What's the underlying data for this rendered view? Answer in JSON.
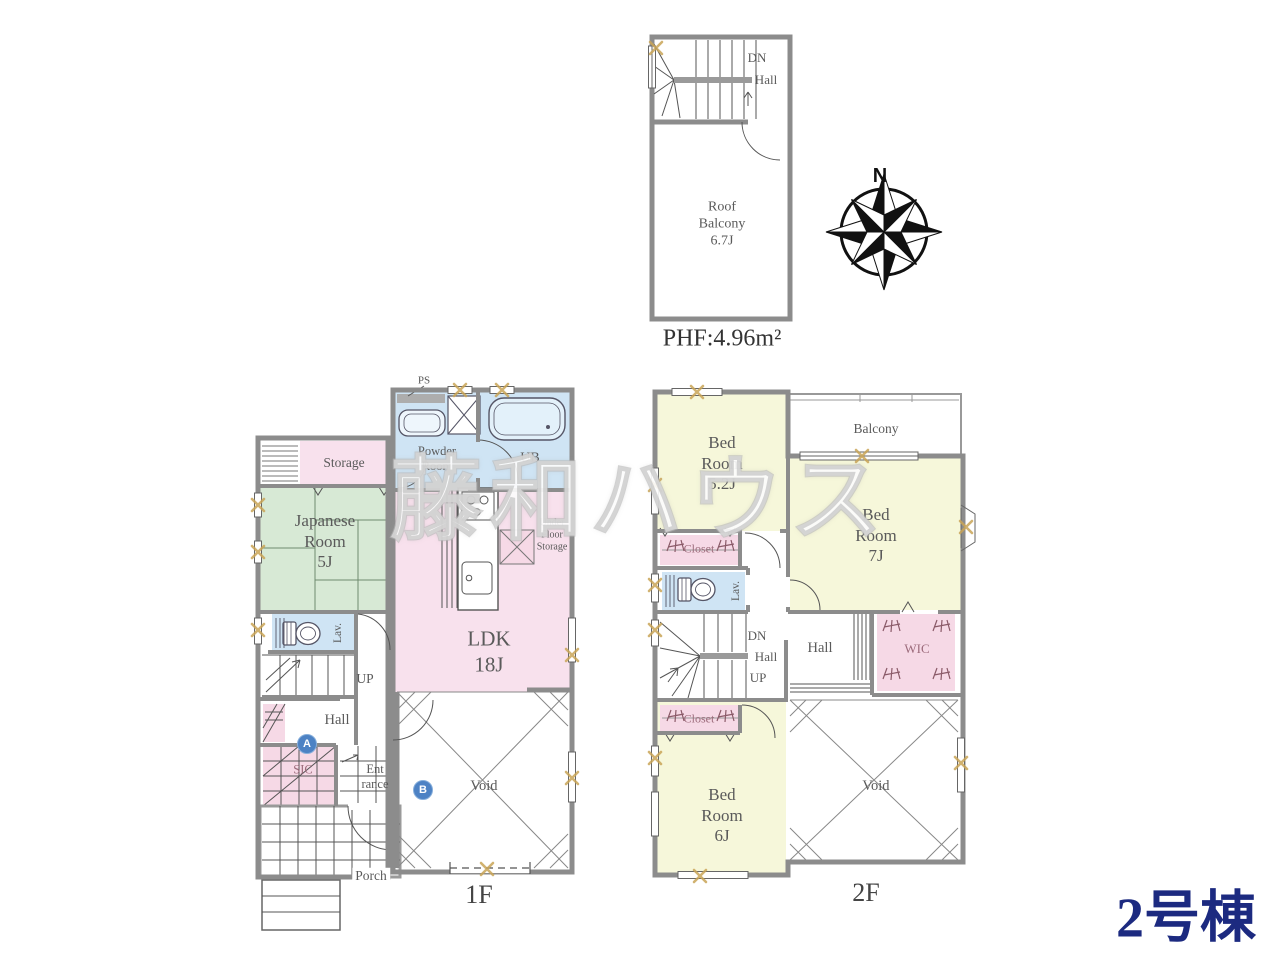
{
  "watermark": "藤和ハウス",
  "building": "2号棟",
  "compass": {
    "north": "N"
  },
  "phf": {
    "dn": "DN",
    "hall": "Hall",
    "roof_balcony": "Roof\nBalcony\n6.7J",
    "area": "PHF:4.96m²"
  },
  "f1": {
    "label": "1F",
    "ps": "PS",
    "powder_room": "Powder\nRoom",
    "ub": "UB",
    "storage": "Storage",
    "japanese_room": "Japanese\nRoom\n5J",
    "under_floor_storage": "Under\nFloor\nStorage",
    "ldk": "LDK\n18J",
    "lav": "Lav.",
    "up": "UP",
    "hall": "Hall",
    "sic": "SIC",
    "entrance": "Ent\nrance",
    "void": "Void",
    "porch": "Porch",
    "marker_a": "A",
    "marker_b": "B"
  },
  "f2": {
    "label": "2F",
    "bedroom_5_2": "Bed\nRoom\n5.2J",
    "balcony": "Balcony",
    "bedroom_7": "Bed\nRoom\n7J",
    "closet_upper": "Closet",
    "lav": "Lav.",
    "dn": "DN",
    "stair_hall": "Hall",
    "up": "UP",
    "hall": "Hall",
    "wic": "WIC",
    "closet_lower": "Closet",
    "bedroom_6": "Bed\nRoom\n6J",
    "void": "Void"
  },
  "colors": {
    "room_pink": "#f8e1ed",
    "room_blue": "#cfe4f4",
    "room_green": "#d7e9d5",
    "room_yellow": "#f6f7da",
    "wall_gray": "#8c8c8c",
    "accent_navy": "#1c2a80",
    "window_mark_tan": "#c9a457"
  }
}
